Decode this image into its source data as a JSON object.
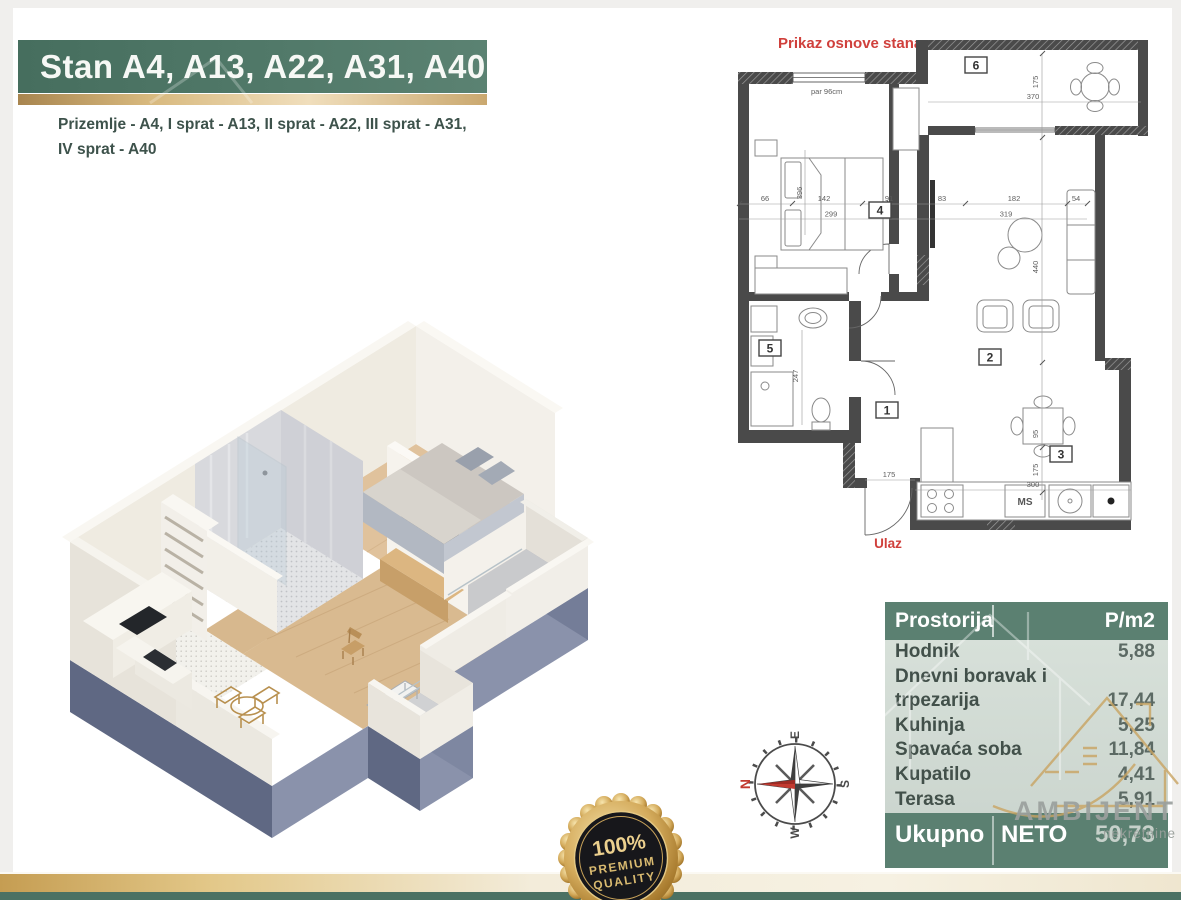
{
  "header": {
    "title": "Stan A4, A13, A22, A31, A40",
    "subtitle_line1": "Prizemlje - A4, I sprat - A13, II sprat - A22, III sprat - A31,",
    "subtitle_line2": "IV sprat - A40"
  },
  "floor_plan": {
    "title": "Prikaz osnove stana",
    "entrance_label": "Ulaz",
    "window_note": "par 96cm",
    "appliance_label": "MS",
    "room_numbers": [
      "1",
      "2",
      "3",
      "4",
      "5",
      "6"
    ],
    "dimensions": {
      "d66": "66",
      "d142": "142",
      "d91": "91",
      "d83": "83",
      "d182": "182",
      "d54": "54",
      "d299": "299",
      "d319": "319",
      "d396": "396",
      "d175": "175",
      "d370": "370",
      "d440": "440",
      "d247": "247",
      "d95": "95",
      "d300": "300"
    }
  },
  "area_table": {
    "header": {
      "room": "Prostorija",
      "area": "P/m2"
    },
    "rows": [
      {
        "room": "Hodnik",
        "area": "5,88"
      },
      {
        "room": "Dnevni boravak i",
        "area": ""
      },
      {
        "room": "trpezarija",
        "area": "17,44"
      },
      {
        "room": "Kuhinja",
        "area": "5,25"
      },
      {
        "room": "Spavaća soba",
        "area": "11,84"
      },
      {
        "room": "Kupatilo",
        "area": "4,41"
      },
      {
        "room": "Terasa",
        "area": "5,91"
      }
    ],
    "footer": {
      "label_left": "Ukupno",
      "label_right": "NETO",
      "value": "50,73"
    }
  },
  "badge": {
    "line1": "100%",
    "line2": "PREMIUM",
    "line3": "QUALITY"
  },
  "compass": {
    "north": "N",
    "east": "E",
    "south": "S",
    "west": "W"
  },
  "logo": {
    "name": "AMBIJENT",
    "tagline": "nekretnine"
  },
  "colors": {
    "banner_green": "#517969",
    "gold_accent": "#caa86f",
    "table_green": "#5b8071",
    "table_body_sage": "#d2dcd4",
    "accent_red": "#d0403c",
    "wall_dark": "#4a4a4a",
    "base_slate": "#8a92ab",
    "wood_floor": "#d9ba90",
    "footer_green": "#4b7163"
  }
}
